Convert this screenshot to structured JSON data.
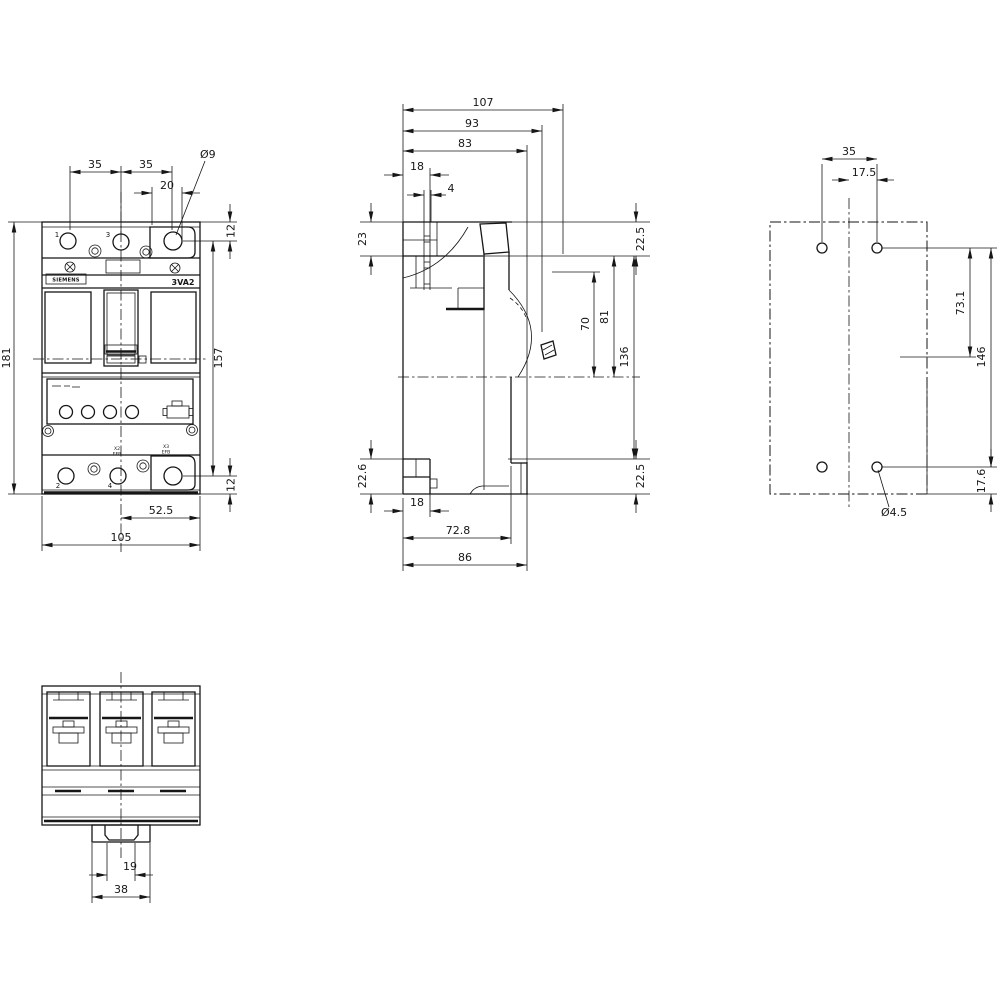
{
  "drawing": {
    "brand": "SIEMENS",
    "model": "3VA2",
    "type": "dimension-drawing-molded-case-circuit-breaker"
  },
  "front": {
    "pitch_a": "35",
    "pitch_b": "35",
    "cover_offset": "20",
    "hole_dia": "Ø9",
    "top_hole_offset": "12",
    "height": "181",
    "hole_pitch_v": "157",
    "bottom_hole_offset": "12",
    "half_width": "52.5",
    "width": "105",
    "pole_top_left": "1",
    "pole_top_mid": "3",
    "pole_bot_left": "2",
    "pole_bot_mid": "4",
    "conn_x2": "X2",
    "conn_x2_sub": "EFB",
    "conn_x3": "X3",
    "conn_x3_sub": "EFB"
  },
  "side": {
    "depth_total": "107",
    "depth_handle": "93",
    "depth_front": "83",
    "terminal_offset": "18",
    "slot_width": "4",
    "top_zone_left": "23",
    "top_zone_right": "22.5",
    "handle_travel": "70",
    "handle_height": "81",
    "front_height": "136",
    "bottom_zone_left": "22.6",
    "bottom_zone_right": "22.5",
    "rail_offset": "18",
    "depth_base": "72.8",
    "depth_rail": "86"
  },
  "drill": {
    "hole_pitch_h": "35",
    "half_pitch": "17.5",
    "mid_offset": "73.1",
    "hole_pitch_v": "146",
    "bottom_offset": "17.6",
    "hole_dia": "Ø4.5"
  },
  "bottom": {
    "tab_inner": "19",
    "tab_outer": "38"
  }
}
